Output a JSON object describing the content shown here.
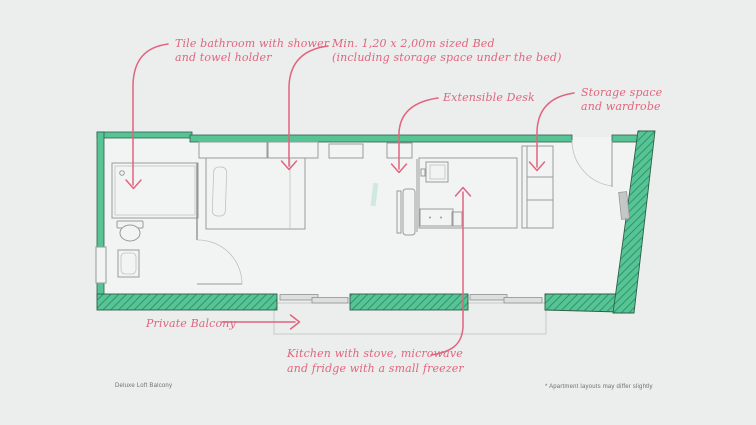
{
  "colors": {
    "background": "#ebeeec",
    "room_floor": "#f2f4f3",
    "wall_teal": "#56c494",
    "wall_hatch": "#2e8e66",
    "wall_edge": "#2e5f4b",
    "furniture_line": "#969c9b",
    "annotation_pink": "#e2647e",
    "footer_text": "#6c7170"
  },
  "annotations": {
    "bathroom": {
      "lines": [
        "Tile bathroom with shower",
        "and towel holder"
      ]
    },
    "bed": {
      "lines": [
        "Min. 1,20 x 2,00m sized Bed",
        "(including storage space under the bed)"
      ]
    },
    "desk": {
      "lines": [
        "Extensible Desk"
      ]
    },
    "storage": {
      "lines": [
        "Storage space",
        "and wardrobe"
      ]
    },
    "balcony": {
      "lines": [
        "Private Balcony"
      ]
    },
    "kitchen": {
      "lines": [
        "Kitchen with stove, microwave",
        "and fridge with a small freezer"
      ]
    }
  },
  "footer": {
    "left": "Deluxe Loft Balcony",
    "right": "* Apartment layouts may differ slightly"
  }
}
